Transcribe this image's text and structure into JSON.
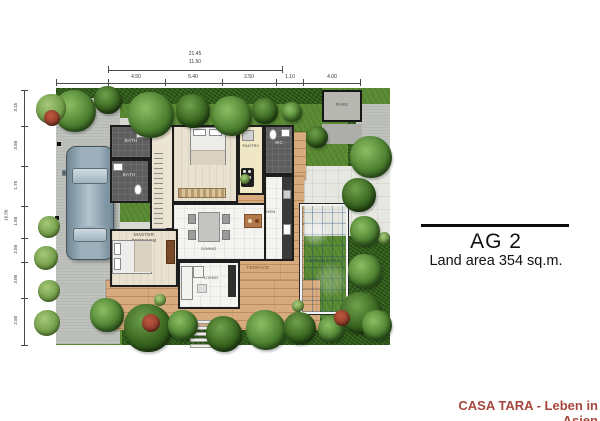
{
  "annotation": {
    "title": "AG 2",
    "subtitle": "Land area 354 sq.m."
  },
  "footer": {
    "text": "CASA TARA - Leben in Asien"
  },
  "rooms": {
    "bedroom2": "BEDROOM 2",
    "pantry": "PANTRY",
    "wc": "WC",
    "bath_top": "BATH",
    "bath_mid": "BATH",
    "dining": "DINING",
    "kitchen": "KITCHEN",
    "master1": "MASTER",
    "master2": "BEDROOM",
    "living": "LIVING"
  },
  "outdoor": {
    "terrace": "TERRACE",
    "pool": "SWIMMING POOL",
    "pad": "PARK"
  },
  "dimensions": {
    "top_overall": "21.45",
    "top_inner": "11.50",
    "top_segments": [
      "4.50",
      "5.40",
      "2.50",
      "1.10",
      "4.00"
    ],
    "left_overall": "16.50",
    "left_segments": [
      "3.15",
      "3.50",
      "1.75",
      "1.50",
      "2.50",
      "3.00",
      "2.50"
    ]
  },
  "colors": {
    "accent_red": "#a6473e",
    "pool_blue": "#3aa0d6",
    "grass_green": "#5a8a33",
    "deck_wood": "#d7ab7d"
  }
}
